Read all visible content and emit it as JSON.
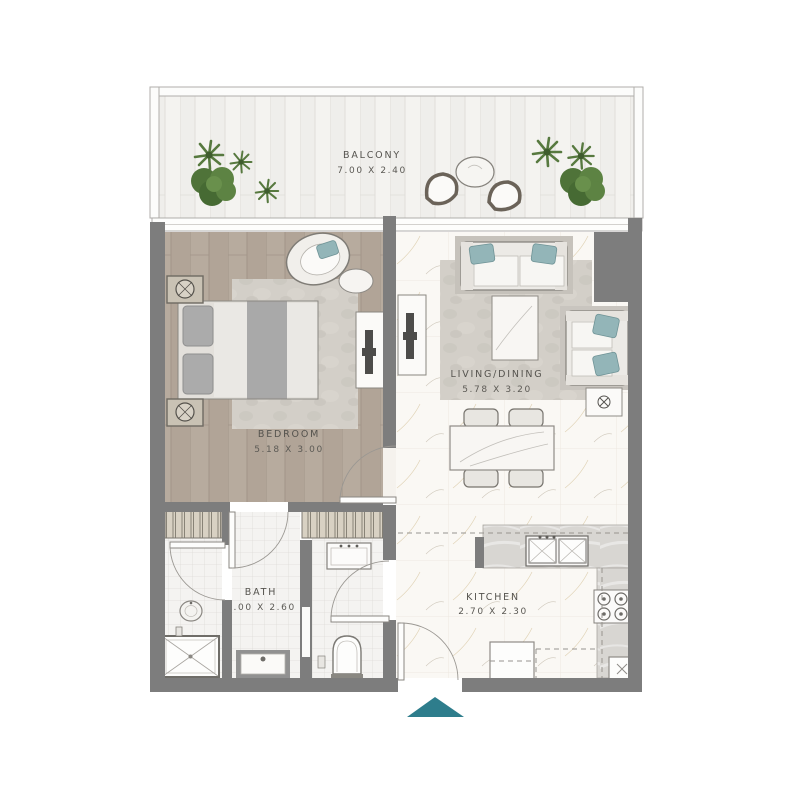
{
  "floor_plan": {
    "type": "apartment-floor-plan",
    "rooms": {
      "balcony": {
        "name": "BALCONY",
        "size": "7.00 X 2.40"
      },
      "bedroom": {
        "name": "BEDROOM",
        "size": "5.18 X 3.00"
      },
      "living_dining": {
        "name": "LIVING/DINING",
        "size": "5.78 X 3.20"
      },
      "bath": {
        "name": "BATH",
        "size": "3.00 X 2.60"
      },
      "kitchen": {
        "name": "KITCHEN",
        "size": "2.70 X 2.30"
      }
    },
    "entry": {
      "marker": "entrance-arrow",
      "color": "#2e7d8c"
    },
    "colors": {
      "walls": "#7d7d7d",
      "teal_accent": "#2e7d8c",
      "cushions": "#93b5b8",
      "bedroom_wood": "#b7ab9e",
      "marble": "#faf8f4",
      "balcony_plank": "#efeeeb",
      "bath_tile": "#f4f3f1",
      "label_text": "#55534e"
    },
    "furniture": {
      "balcony": [
        "potted-plants",
        "round-table",
        "two-lounge-chairs"
      ],
      "bedroom": [
        "double-bed",
        "two-nightstands-with-lamps",
        "area-rug",
        "lounge-chair",
        "round-side-table",
        "tv-console"
      ],
      "living_dining": [
        "two-seat-sofa",
        "coffee-table",
        "loveseat",
        "lamp-side-table",
        "dining-table",
        "four-dining-chairs",
        "tv-console",
        "area-rug"
      ],
      "bath": [
        "wardrobe",
        "walk-in-shower",
        "pedestal-basin",
        "vanity-sink",
        "wc-sink",
        "toilet"
      ],
      "kitchen": [
        "double-sink",
        "four-burner-hob",
        "l-shaped-counter",
        "fridge",
        "washer"
      ]
    }
  }
}
